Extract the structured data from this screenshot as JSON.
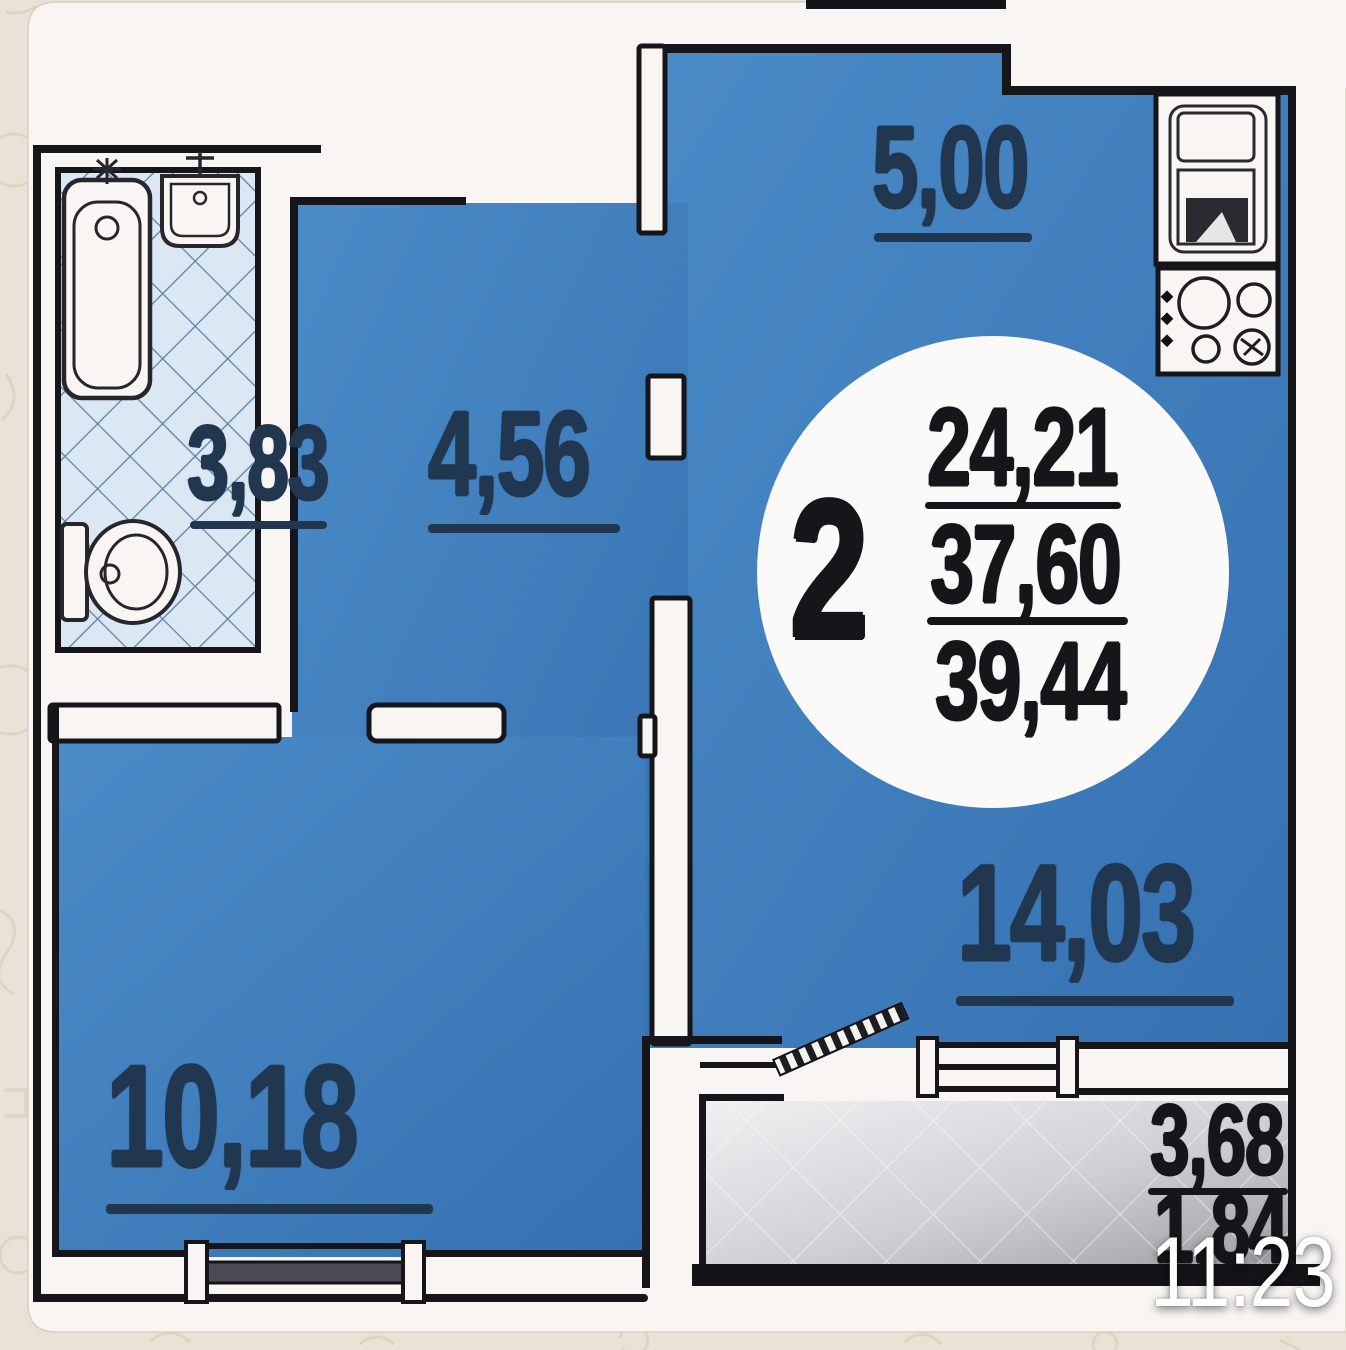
{
  "plan": {
    "title": "apartment floor plan (2-room euro layout)",
    "summary": {
      "rooms_count": "2",
      "living_area": "24,21",
      "apartment_area": "37,60",
      "total_area": "39,44"
    },
    "rooms": {
      "bathroom": {
        "name": "bathroom",
        "area": "3,83"
      },
      "hallway": {
        "name": "hallway",
        "area": "4,56"
      },
      "kitchen": {
        "name": "kitchen",
        "area": "5,00"
      },
      "living_room": {
        "name": "living room",
        "area": "14,03"
      },
      "bedroom": {
        "name": "bedroom",
        "area": "10,18"
      },
      "balcony": {
        "name": "balcony",
        "area": "3,68",
        "area_reduced": "1,84"
      }
    },
    "icons": [
      "bathtub-icon",
      "bath-sink-icon",
      "toilet-icon",
      "kitchen-sink-unit-icon",
      "stove-icon",
      "balcony-door-leaf",
      "balcony-window",
      "bedroom-window"
    ],
    "colors": {
      "room_blue": "#3e7fc0",
      "wall_black": "#15151a",
      "tile_blue": "#dbe7f3",
      "balcony_gray": "#cfd0d4",
      "card_white": "#f8f5f2",
      "background_beige": "#eae2d6",
      "label_navy": "#21374f",
      "timestamp_white": "#ffffff"
    }
  },
  "overlay": {
    "timestamp": "11:23"
  }
}
